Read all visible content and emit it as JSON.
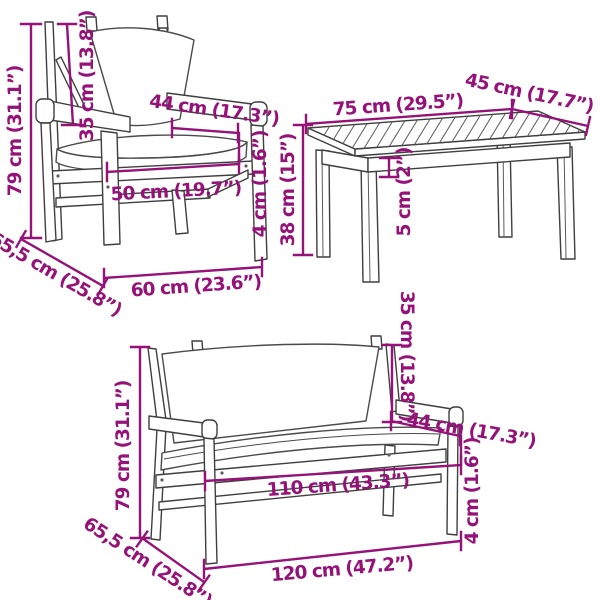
{
  "diagram_title": "3-piece garden furniture set dimension diagram",
  "colors": {
    "dimension_annotation": "#951379",
    "line_art": "#3f3f3f"
  },
  "armchair": {
    "dimensions": {
      "height": "79 cm (31.1”)",
      "backrest_height": "35 cm (13.8”)",
      "seat_depth": "44 cm (17.3”)",
      "cushion_thickness": "4 cm (1.6”)",
      "seat_width": "50 cm (19.7”)",
      "width": "60 cm (23.6”)",
      "depth": "65,5 cm (25.8”)"
    }
  },
  "coffee_table": {
    "dimensions": {
      "length": "75 cm (29.5”)",
      "width": "45 cm (17.7”)",
      "height": "38 cm (15”)",
      "tabletop_thickness": "5 cm (2”)"
    }
  },
  "bench": {
    "dimensions": {
      "height": "79 cm (31.1”)",
      "backrest_height": "35 cm (13.8”)",
      "seat_depth": "44 cm (17.3”)",
      "cushion_thickness": "4 cm (1.6”)",
      "seat_width": "110 cm (43.3”)",
      "width": "120 cm (47.2”)",
      "depth": "65,5 cm (25.8”)"
    }
  }
}
